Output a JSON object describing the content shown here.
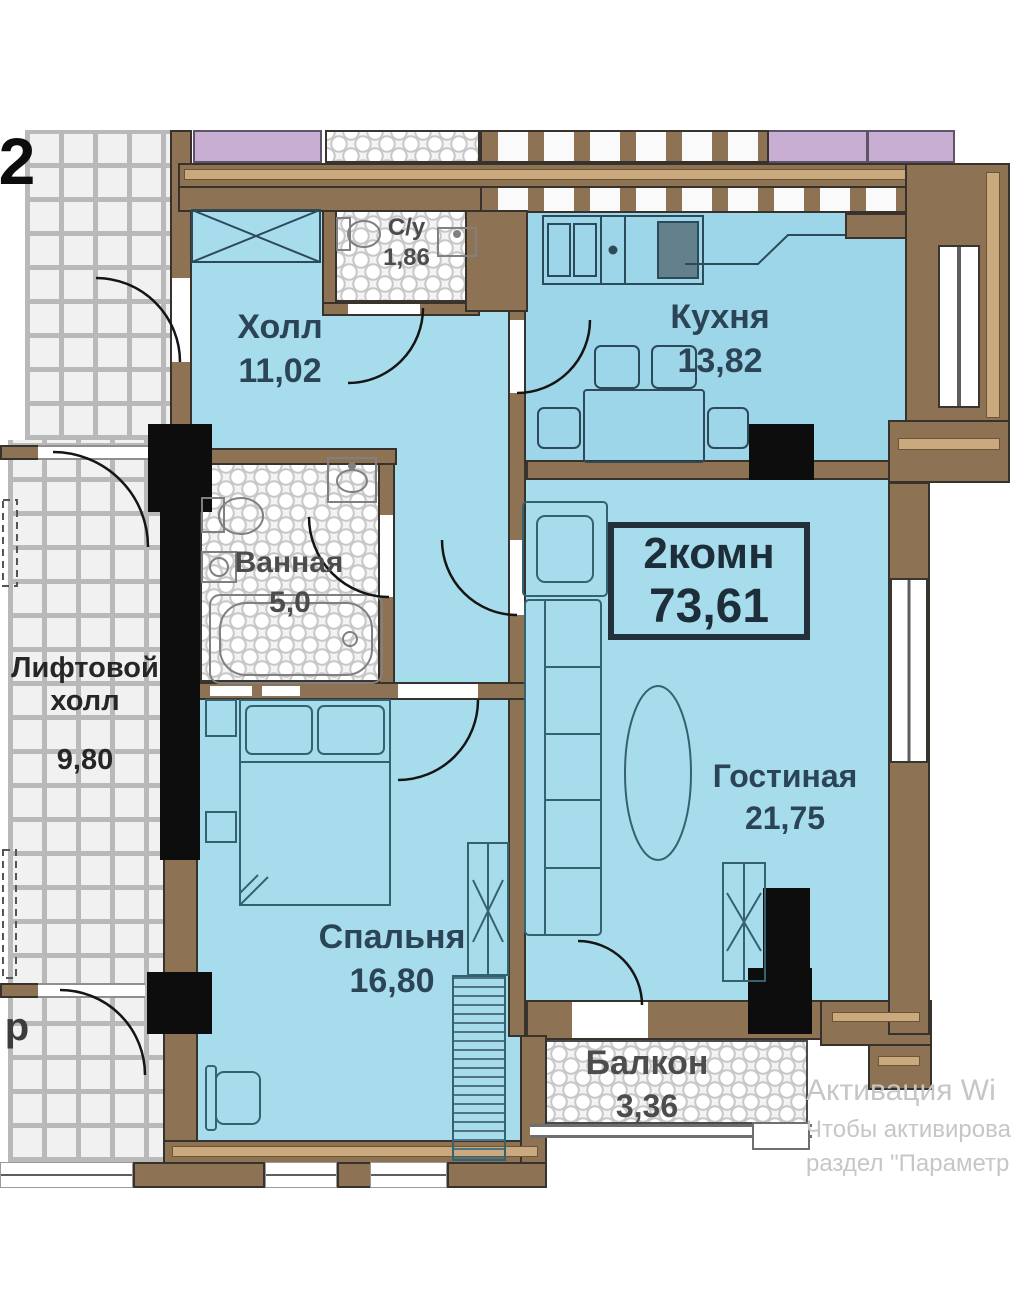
{
  "plan": {
    "floor_label": "2",
    "badge": {
      "type_label": "2комн",
      "total_area": "73,61"
    },
    "rooms": [
      {
        "key": "wc",
        "name": "С/у",
        "area": "1,86"
      },
      {
        "key": "hall",
        "name": "Холл",
        "area": "11,02"
      },
      {
        "key": "kitchen",
        "name": "Кухня",
        "area": "13,82"
      },
      {
        "key": "bathroom",
        "name": "Ванная",
        "area": "5,0"
      },
      {
        "key": "lift-hall",
        "name": "Лифтовой холл",
        "area": "9,80"
      },
      {
        "key": "living",
        "name": "Гостиная",
        "area": "21,75"
      },
      {
        "key": "bedroom",
        "name": "Спальня",
        "area": "16,80"
      },
      {
        "key": "balcony",
        "name": "Балкон",
        "area": "3,36"
      }
    ],
    "corridor_text_partial": "р",
    "colors": {
      "room_fill": "#a7dcec",
      "kitchen_fill": "#9cd6e8",
      "wall": "#8d7353",
      "wall_trim": "#c9a97d",
      "shaft": "#0d0d0d",
      "lilac": "#c9aed4",
      "label_blue": "#2b4556",
      "label_gray": "#4c4c4c",
      "watermark": "#c6c6c6"
    }
  },
  "watermark": {
    "line1": "Активация Wi",
    "line2": "Чтобы активирова",
    "line3": "раздел \"Параметр"
  }
}
